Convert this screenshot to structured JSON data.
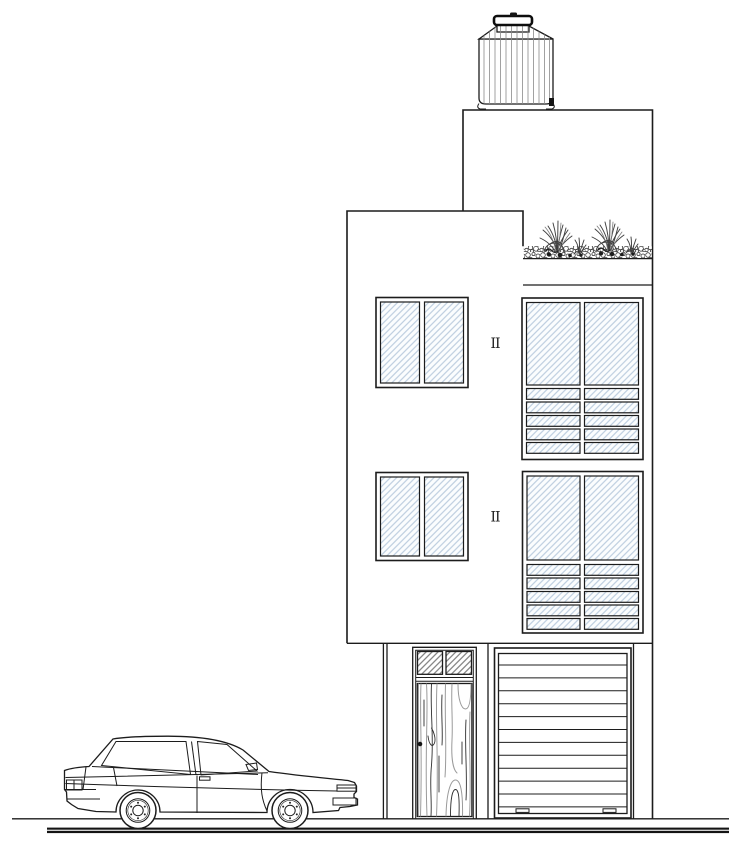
{
  "page": {
    "description": "Architectural front elevation of a three-level row house with rooftop water tank, roof-garden planter, hatched glazing, wooden entry door, roller garage door and a sedan parked at the curb",
    "visible_text": "none (line drawing; only window marker glyphs)"
  },
  "colors": {
    "paper": "#ffffff",
    "line": "#1c1c1c",
    "glass_hatch": "#b5c8db",
    "glass_bg": "#fbfdfe",
    "gray_hatch": "#787878",
    "rib": "#8a8a8a",
    "wood_grain": "#9a9a9a",
    "wood_dark": "#2e2e2e",
    "plant": "#3f3f3f",
    "gravel": "#3c3c3c",
    "ground": "#141414"
  },
  "drawing": {
    "window_marker": "II",
    "levels": 3,
    "water_tank": {
      "type": "rooftop cistern",
      "ribbed": true,
      "lid": true
    },
    "roof_garden": {
      "plant_clumps": 2,
      "bed": "gravel"
    },
    "windows": [
      {
        "id": "third-floor-left",
        "panes": 2,
        "louver_strips": 0
      },
      {
        "id": "third-floor-right",
        "panes": 2,
        "louver_strips": 5
      },
      {
        "id": "second-floor-left",
        "panes": 2,
        "louver_strips": 0
      },
      {
        "id": "second-floor-right",
        "panes": 2,
        "louver_strips": 5
      }
    ],
    "entry_door": {
      "material": "wood grain",
      "transom_panels": 2,
      "knob": 1
    },
    "garage_door": {
      "slats": 13,
      "handles": 2
    },
    "car": {
      "type": "sedan",
      "wheels": 2,
      "facing": "right",
      "side_windows": 2
    }
  }
}
